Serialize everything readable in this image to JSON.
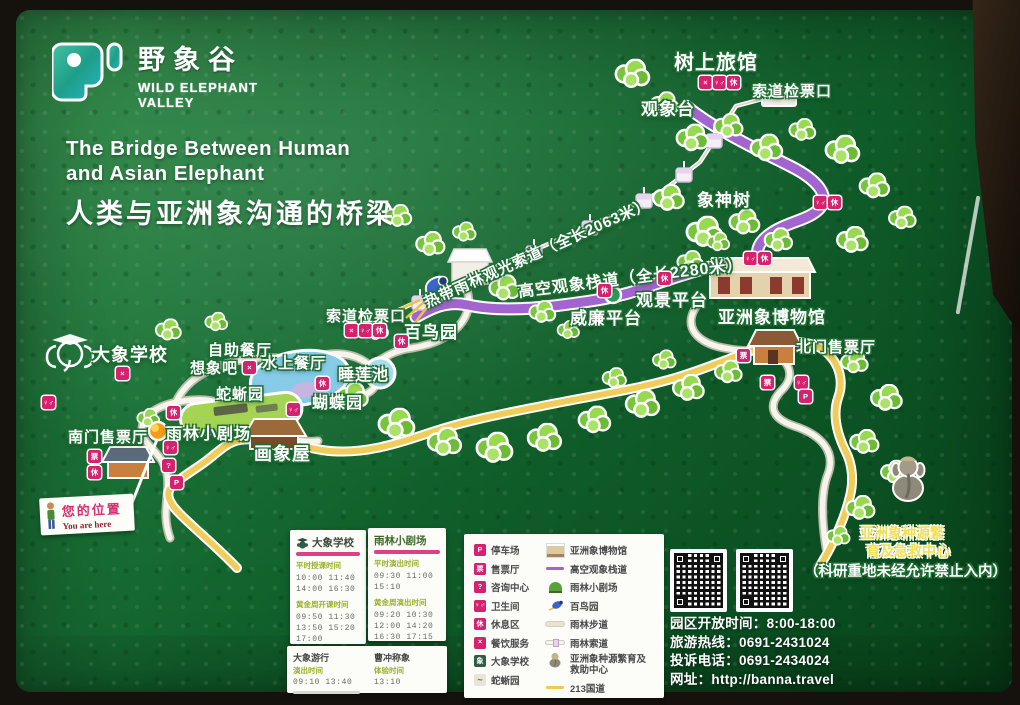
{
  "logo": {
    "cn": "野象谷",
    "en1": "WILD ELEPHANT",
    "en2": "VALLEY"
  },
  "title": {
    "en1": "The Bridge Between Human",
    "en2": "and Asian Elephant",
    "cn": "人类与亚洲象沟通的桥梁"
  },
  "routes": {
    "cableway_label": "热带雨林观光索道（全长2063米）",
    "walkway_label": "高空观象栈道（全长2280米）"
  },
  "map_labels": [
    "树上旅馆",
    "索道检票口",
    "观象台",
    "象神树",
    "观景平台",
    "威廉平台",
    "亚洲象博物馆",
    "北门售票厅",
    "索道检票口",
    "百鸟园",
    "睡莲池",
    "蝴蝶园",
    "蛇蜥园",
    "自助餐厅",
    "想象吧",
    "水上餐厅",
    "大象学校",
    "雨林小剧场",
    "画象屋",
    "南门售票厅"
  ],
  "you_are_here": {
    "cn": "您的位置",
    "en": "You are here"
  },
  "breeding_center": {
    "line1": "亚洲象种源繁",
    "line2": "育及急救中心",
    "notice": "（科研重地未经允许禁止入内）"
  },
  "icons": {
    "parking": "P",
    "info": "?",
    "dining": "×",
    "toilet": "♀♂",
    "rest": "休",
    "ticket": "票"
  },
  "schedules": {
    "school": {
      "title": "大象学校",
      "s1_heading": "平时授课时间",
      "s1_times": [
        "10:00 11:40",
        "14:00 16:30"
      ],
      "s2_heading": "黄金周开课时间",
      "s2_times": [
        "09:50 11:30",
        "13:50 15:20",
        "17:00"
      ]
    },
    "theater": {
      "title": "雨林小剧场",
      "s1_heading": "平时演出时间",
      "s1_times": [
        "09:30 11:00",
        "15:10"
      ],
      "s2_heading": "黄金周演出时间",
      "s2_times": [
        "09:20 10:30",
        "12:00 14:20",
        "16:30 17:15"
      ]
    },
    "parade": {
      "title": "大象游行",
      "heading": "演出时间",
      "times": "09:10 13:40"
    },
    "weigh": {
      "title": "曹冲称象",
      "heading": "体验时间",
      "times": "13:10"
    }
  },
  "legend": {
    "left": [
      {
        "label": "停车场"
      },
      {
        "label": "售票厅"
      },
      {
        "label": "咨询中心"
      },
      {
        "label": "卫生间"
      },
      {
        "label": "休息区"
      },
      {
        "label": "餐饮服务"
      },
      {
        "label": "大象学校"
      },
      {
        "label": "蛇蜥园"
      }
    ],
    "right": [
      {
        "label": "亚洲象博物馆"
      },
      {
        "label": "高空观象栈道"
      },
      {
        "label": "雨林小剧场"
      },
      {
        "label": "百鸟园"
      },
      {
        "label": "雨林步道"
      },
      {
        "label": "雨林索道"
      },
      {
        "label": "亚洲象种源繁育及救助中心"
      },
      {
        "label": "213国道"
      }
    ]
  },
  "info_lines": [
    "园区开放时间：8:00-18:00",
    "旅游热线：0691-2431024",
    "投诉电话：0691-2434024",
    "网址：http://banna.travel"
  ],
  "colors": {
    "board_green": "#15682f",
    "icon_magenta": "#d6216e",
    "walkway_purple": "#a265cf",
    "highway_yellow": "#f0cd5a",
    "cable_white": "#f5f1e8"
  }
}
